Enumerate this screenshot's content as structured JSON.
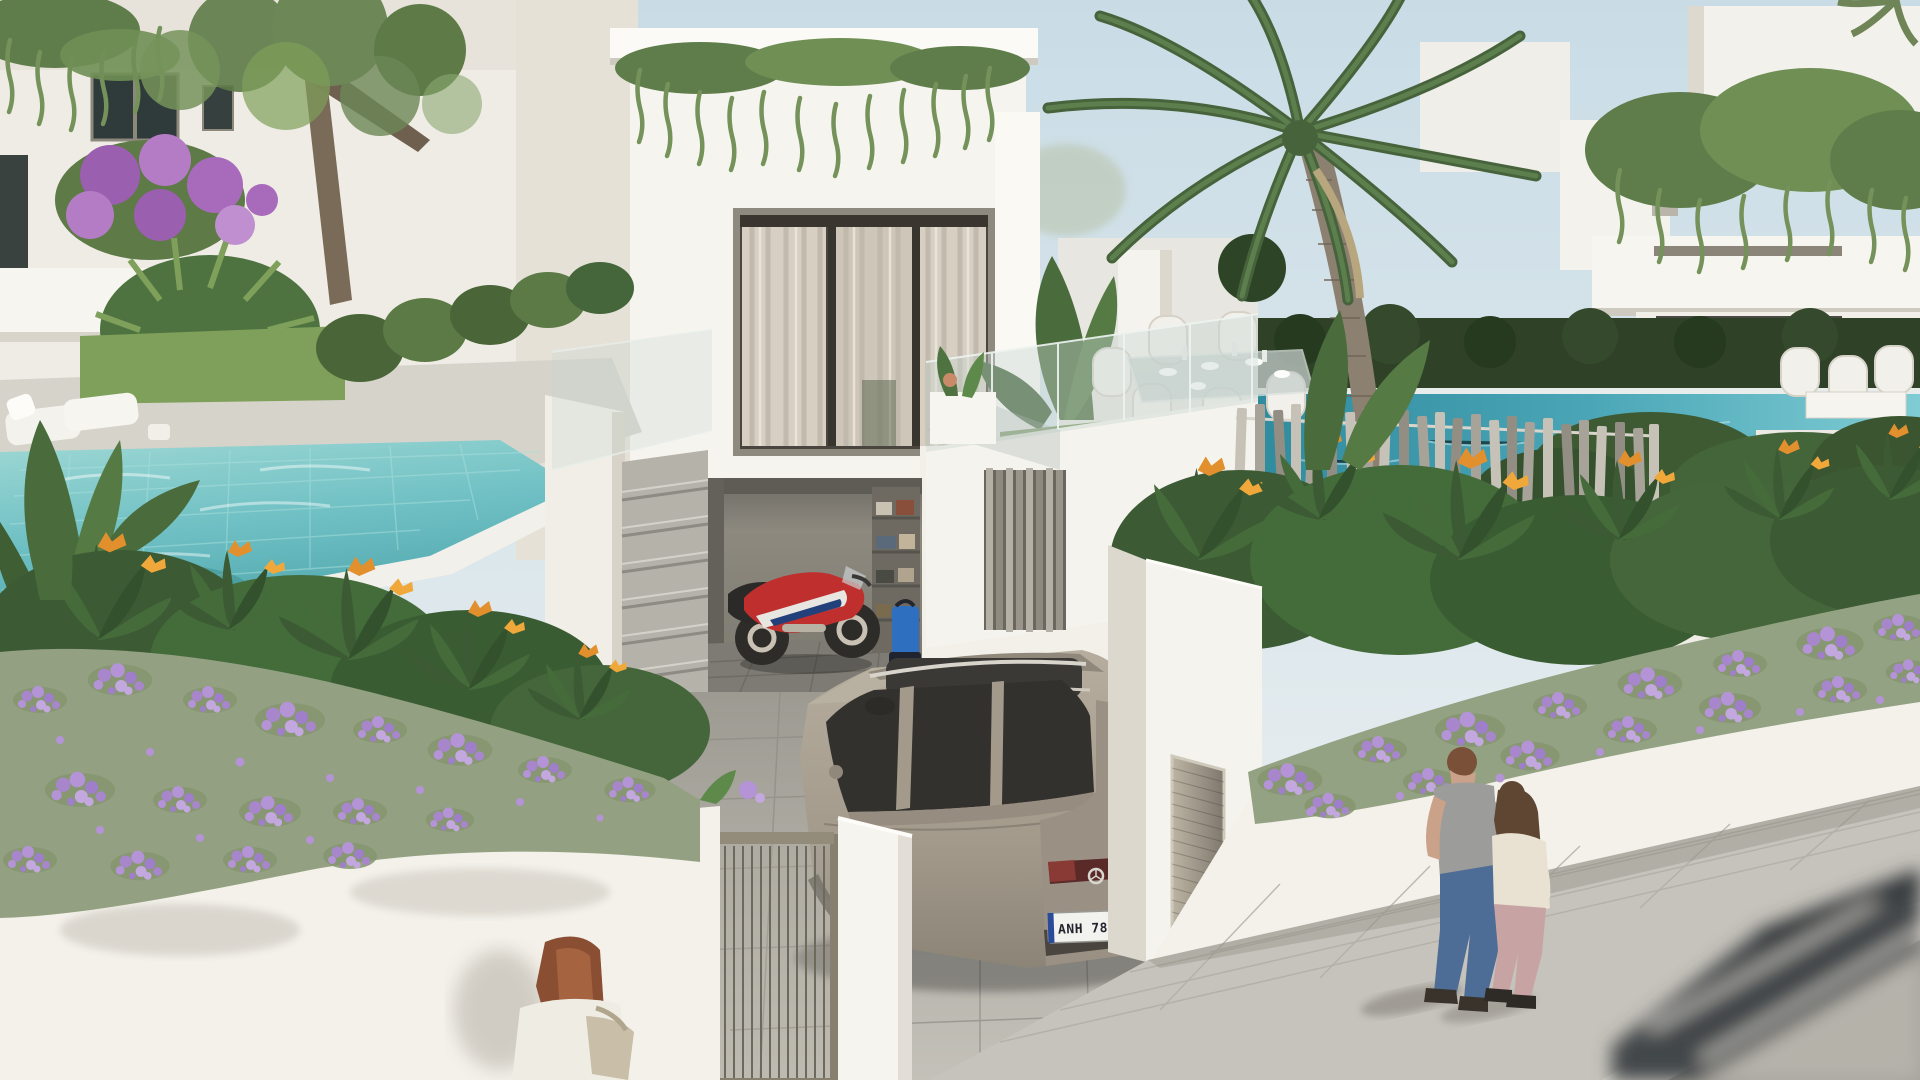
{
  "scene": {
    "title": "Modern white villa development — photorealistic exterior render",
    "description": "Daytime 3D architectural rendering of a row of modern white villas. Center villa has sheer-curtained glass doors, a rooftop planter with trailing greenery, a grass terrace with glass balustrade and outdoor dining set above an open garage containing a red sport motorcycle, storage shelves and a blue pressure washer. A champagne-silver Mercedes SUV is parked in the driveway behind a barred entry gate. Left villa garden has a turquoise tiled pool, white sun loungers, a tree and purple bougainvillea. Right garden has a teal pool behind a brushed-steel slat fence, a tall palm tree and bird-of-paradise plants. Street-side white walls overflow with cascading purple trailing flowers. A couple walks along the gray paver sidewalk, a red-haired woman in a white jacket stands lower left, and a motion-blurred car passes on the road at lower right.",
    "license_plate": {
      "text": "ANH 7852"
    },
    "palette": {
      "sky": "#c9dce6",
      "wall_white": "#f5f3ee",
      "wall_shadow": "#ddd8cd",
      "pool_turquoise": "#6fc0c4",
      "pool_teal": "#3f9fb0",
      "foliage_dark": "#3c5a33",
      "foliage_light": "#7fa05a",
      "flower_purple": "#a886cc",
      "flower_orange": "#e2902e",
      "car_champagne": "#a39a8c",
      "motorcycle_red": "#bf2f2e",
      "paver_gray": "#c6c3bc",
      "road_gray": "#a5a29c"
    },
    "objects": [
      "left neighbor villa with dark-framed windows and hanging balcony plants",
      "purple bougainvillea and fatsia plants",
      "garden tree with feathery canopy",
      "main villa with sheer-curtained sliding glass doors",
      "rooftop trailing plant fringe",
      "grass terrace with glass balustrade",
      "white rattan outdoor dining set with glass table",
      "open garage with red sport motorcycle",
      "garage storage shelf with boxes",
      "blue pressure washer",
      "champagne Mercedes SUV with license plate",
      "barred pedestrian entry gate and white pillar",
      "outdoor staircase",
      "left turquoise tiled pool with white sun loungers",
      "banana plants",
      "brushed steel slat pool fence",
      "teal pool of right villa",
      "tall palm tree",
      "bird-of-paradise plants with orange flowers",
      "white walls cascading with purple trailing flowers",
      "right villa with roof-edge greenery, hedges and white chairs",
      "louvered service door in privacy wall",
      "gray paver sidewalk, curb and road",
      "motion-blurred passing car"
    ],
    "people": [
      "man in gray t-shirt and blue jeans walking with arm around woman",
      "woman with long brown hair, cream top and pink trousers",
      "red-haired woman in white jacket with beige shoulder bag, lower left"
    ]
  }
}
